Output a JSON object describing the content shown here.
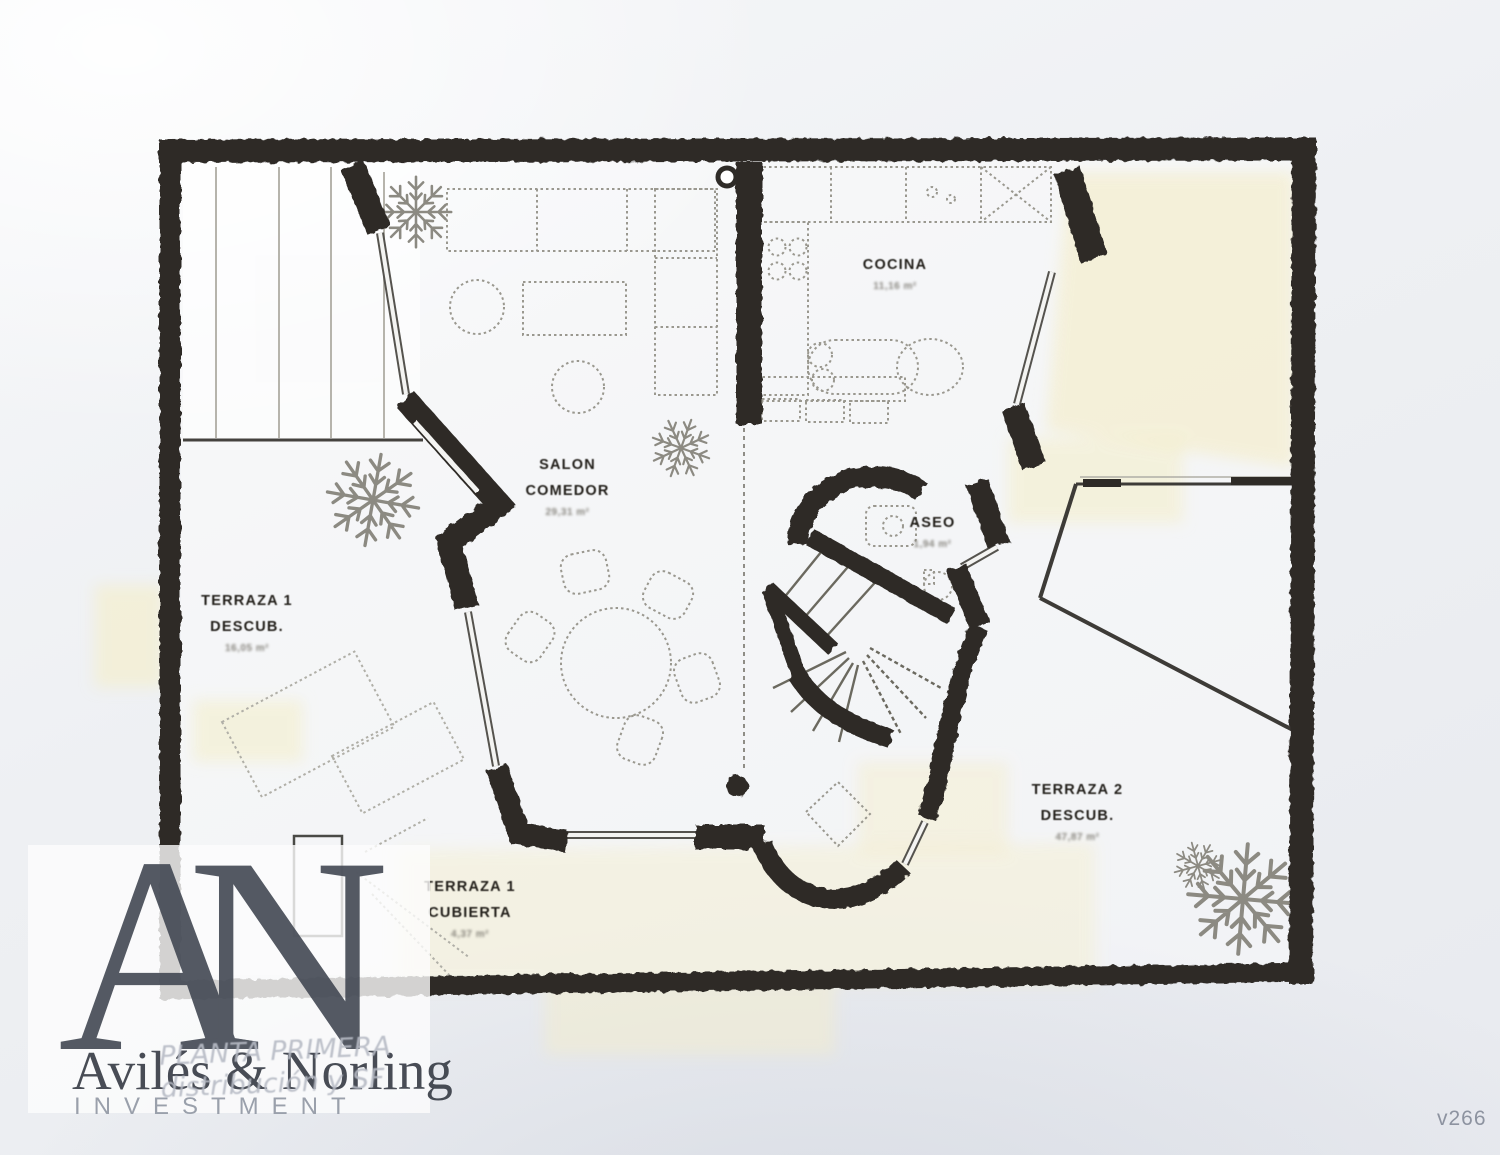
{
  "rooms": {
    "cocina": {
      "name": "COCINA",
      "area": "11,16 m²"
    },
    "salon_comedor": {
      "line1": "SALON",
      "line2": "COMEDOR",
      "area": "29,31 m²"
    },
    "aseo": {
      "name": "ASEO",
      "area": "1,94 m²"
    },
    "terraza_1": {
      "line1": "TERRAZA 1",
      "line2": "DESCUB.",
      "area": "16,05 m²"
    },
    "terraza_2": {
      "line1": "TERRAZA 2",
      "line2": "DESCUB.",
      "area": "47,87 m²"
    },
    "terraza_cubierta": {
      "line1": "TERRAZA 1",
      "line2": "CUBIERTA",
      "area": "4,37 m²"
    }
  },
  "caption": {
    "line1": "PLANTA PRIMERA",
    "line2": "distribución y SF"
  },
  "watermark": {
    "monogram": "AN",
    "company": "Avilés & Norling",
    "tagline": "INVESTMENT"
  },
  "page_tag": {
    "version": "v266"
  },
  "colors": {
    "ink": "#2e2b27",
    "paper": "#eef0f3",
    "highlight": "#f4eecb",
    "watermark_text": "#474d57",
    "caption_text": "#b6bac4"
  }
}
